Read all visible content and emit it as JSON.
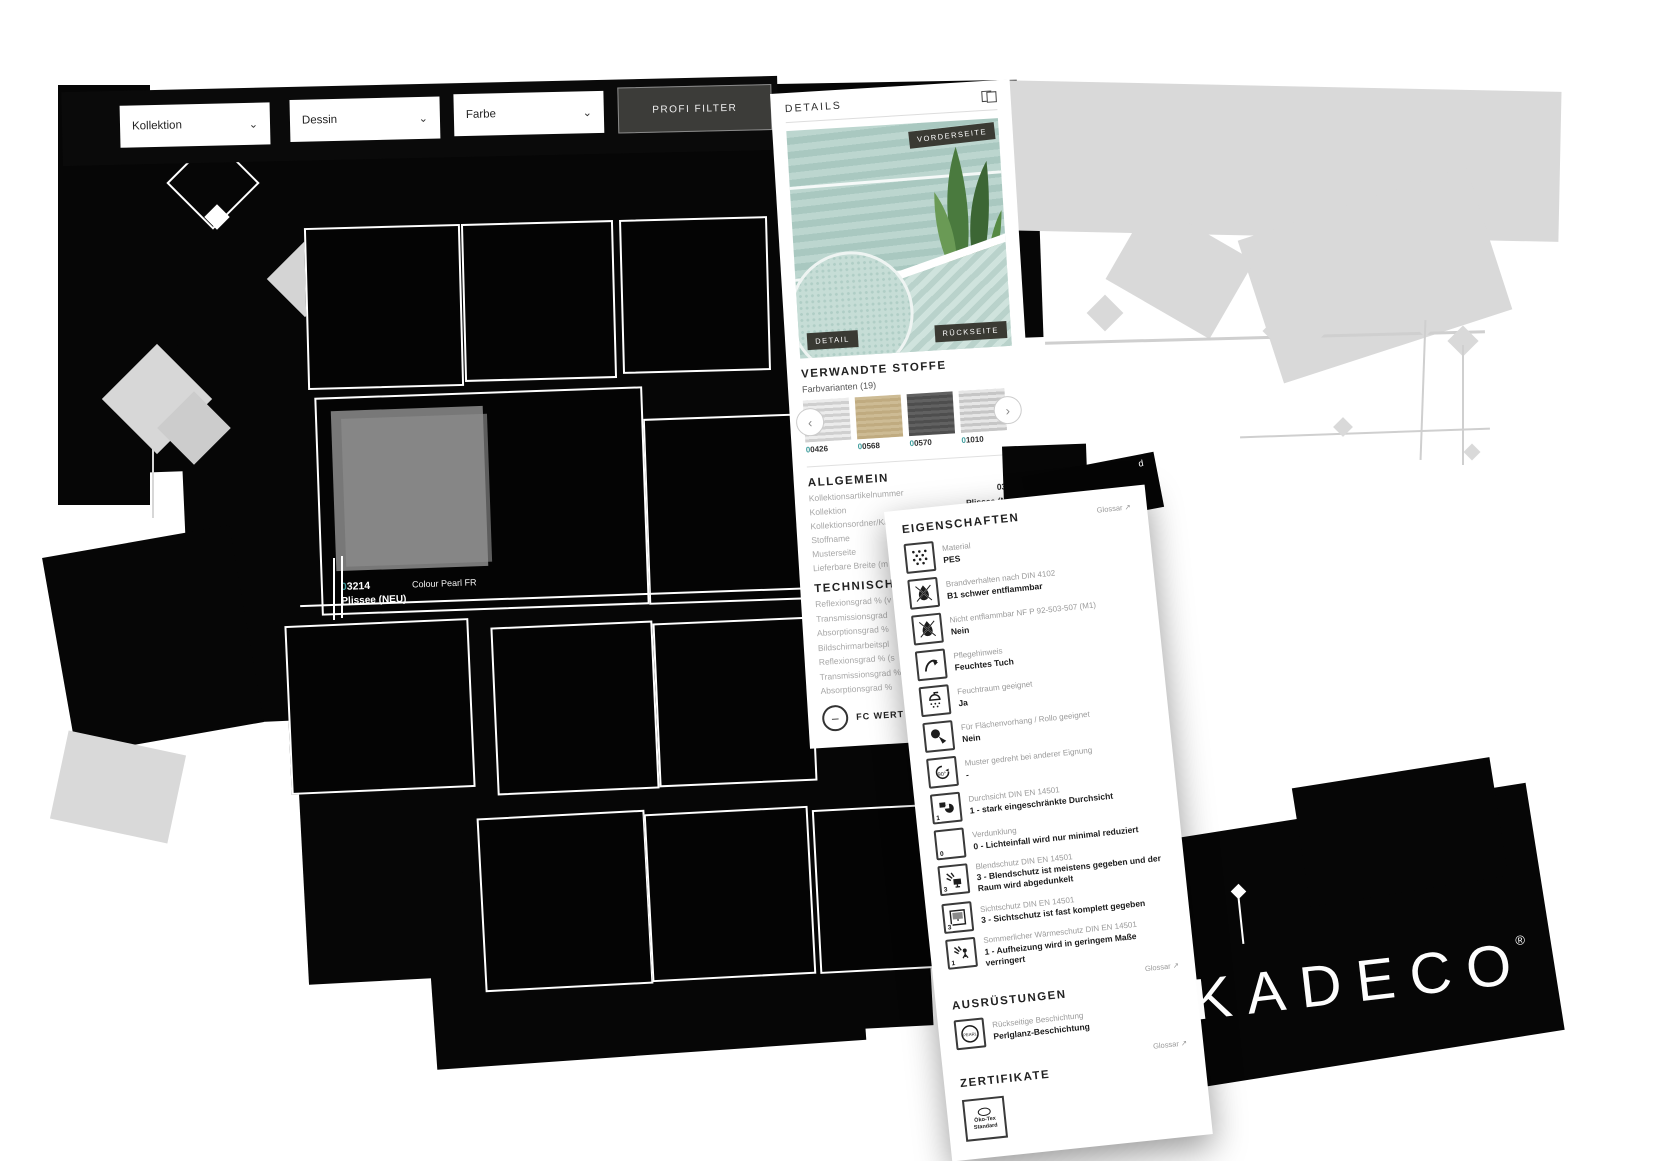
{
  "colors": {
    "accent_teal": "#3f9d9d",
    "fabric_mint": "#aec9c1",
    "glitch_gray": "#d9d9d9",
    "panel_bg": "#ffffff",
    "badge_bg": "#3a3a33"
  },
  "icons": {
    "chevron_down": "⌄",
    "prev": "‹",
    "next": "›",
    "glossar_arrow": "↗",
    "minus": "–"
  },
  "filters": {
    "kollektion_label": "Kollektion",
    "dessin_label": "Dessin",
    "farbe_label": "Farbe",
    "profi_filter_label": "PROFI FILTER"
  },
  "grid": {
    "selected": {
      "code_prefix": "0",
      "code_rest": "3214",
      "fabric_name": "Colour Pearl FR",
      "collection": "Plissee (NEU)"
    }
  },
  "details": {
    "title": "DETAILS",
    "badge_front": "VORDERSEITE",
    "badge_detail": "DETAIL",
    "badge_back": "RÜCKSEITE",
    "related_title": "VERWANDTE STOFFE",
    "related_subtitle": "Farbvarianten (19)",
    "swatches": [
      {
        "code_prefix": "0",
        "code_rest": "0426"
      },
      {
        "code_prefix": "0",
        "code_rest": "0568"
      },
      {
        "code_prefix": "0",
        "code_rest": "0570"
      },
      {
        "code_prefix": "0",
        "code_rest": "1010"
      }
    ],
    "allgemein_title": "ALLGEMEIN",
    "allgemein_rows": [
      {
        "label": "Kollektionsartikelnummer",
        "value": "03155"
      },
      {
        "label": "Kollektion",
        "value": "Plissee (NEU)"
      },
      {
        "label": "Kollektionsordner/Karte",
        "value": "Plissee"
      },
      {
        "label": "Stoffname",
        "value": "Colour Pearl FR"
      },
      {
        "label": "Musterseite",
        "value": ""
      },
      {
        "label": "Lieferbare Breite (m",
        "value": ""
      }
    ],
    "technisch_title": "TECHNISCHE W",
    "technisch_rows": [
      "Reflexionsgrad % (v",
      "Transmissionsgrad",
      "Absorptionsgrad %",
      "Bildschirmarbeitspl",
      "Reflexionsgrad % (s",
      "Transmissionsgrad %",
      "Absorptionsgrad %"
    ],
    "fc_button_label": "FC WERT B"
  },
  "fragment": {
    "line1": "d",
    "line2": "aufträge - Of"
  },
  "properties": {
    "title": "EIGENSCHAFTEN",
    "glossar_label": "Glossar",
    "items": [
      {
        "icon": "material-icon",
        "label": "Material",
        "value": "PES"
      },
      {
        "icon": "flammability-icon",
        "label": "Brandverhalten nach DIN 4102",
        "value": "B1 schwer entflammbar"
      },
      {
        "icon": "non-flammable-icon",
        "label": "Nicht entflammbar NF P 92-503-507 (M1)",
        "value": "Nein"
      },
      {
        "icon": "care-wipe-icon",
        "label": "Pflegehinweis",
        "value": "Feuchtes Tuch"
      },
      {
        "icon": "damp-room-icon",
        "label": "Feuchtraum geeignet",
        "value": "Ja"
      },
      {
        "icon": "panel-roller-icon",
        "label": "Für Flächenvorhang / Rollo geeignet",
        "value": "Nein"
      },
      {
        "icon": "rotate-90-icon",
        "label": "Muster gedreht bei anderer Eignung",
        "value": "-"
      },
      {
        "icon": "transparency-icon",
        "label": "Durchsicht DIN EN 14501",
        "value": "1 - stark eingeschränkte Durchsicht",
        "badge": "1"
      },
      {
        "icon": "dimout-icon",
        "label": "Verdunklung",
        "value": "0 - Lichteinfall wird nur minimal reduziert",
        "badge": "0"
      },
      {
        "icon": "glare-icon",
        "label": "Blendschutz DIN EN 14501",
        "value": "3 - Blendschutz ist meistens gegeben und der Raum wird abgedunkelt",
        "badge": "3"
      },
      {
        "icon": "privacy-icon",
        "label": "Sichtschutz DIN EN 14501",
        "value": "3 - Sichtschutz ist fast komplett gegeben",
        "badge": "3"
      },
      {
        "icon": "heat-icon",
        "label": "Sommerlicher Wärmeschutz DIN EN 14501",
        "value": "1 - Aufheizung wird in geringem Maße verringert",
        "badge": "1"
      }
    ],
    "ausruestungen_title": "AUSRÜSTUNGEN",
    "ausruestungen_items": [
      {
        "icon": "pearl-coating-icon",
        "label": "Rückseitige Beschichtung",
        "value": "Perlglanz-Beschichtung"
      }
    ],
    "zertifikate_title": "ZERTIFIKATE",
    "cert_line1": "Öko-Tex",
    "cert_line2": "Standard"
  },
  "brand": {
    "logo": "KADECO",
    "registered": "®"
  }
}
